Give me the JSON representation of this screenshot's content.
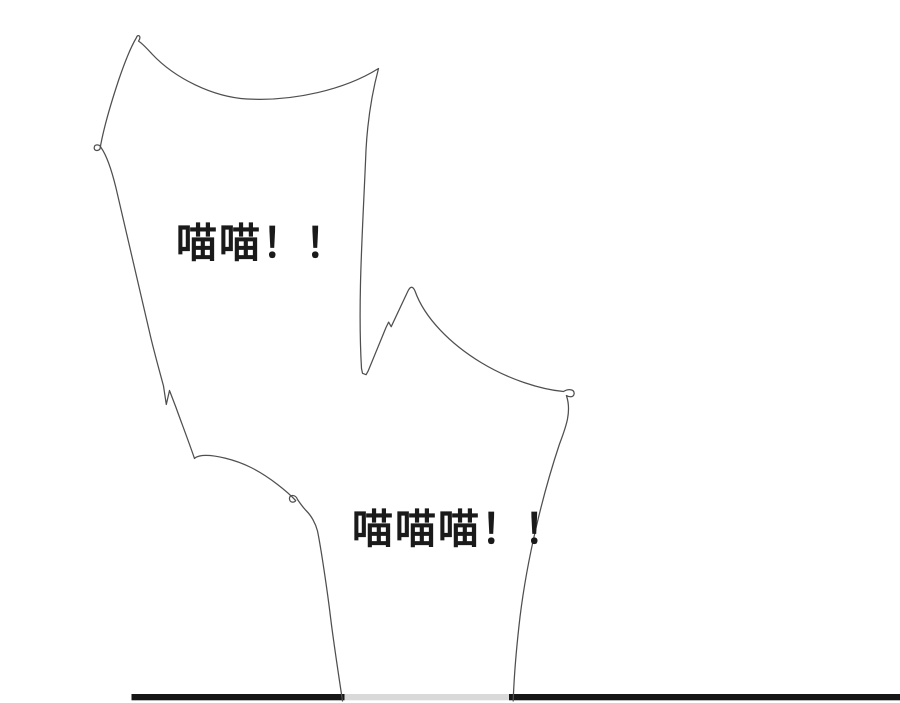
{
  "colors": {
    "background": "#ffffff",
    "bubble_fill": "#ffffff",
    "bubble_outline": "#4f4f4f",
    "text": "#1a1a1a",
    "ground_line": "#161616",
    "ground_line_behind_bubble": "#d9d9d9"
  },
  "bubbles": {
    "top": {
      "text": "喵喵！！"
    },
    "bottom": {
      "text": "喵喵喵！！"
    }
  }
}
